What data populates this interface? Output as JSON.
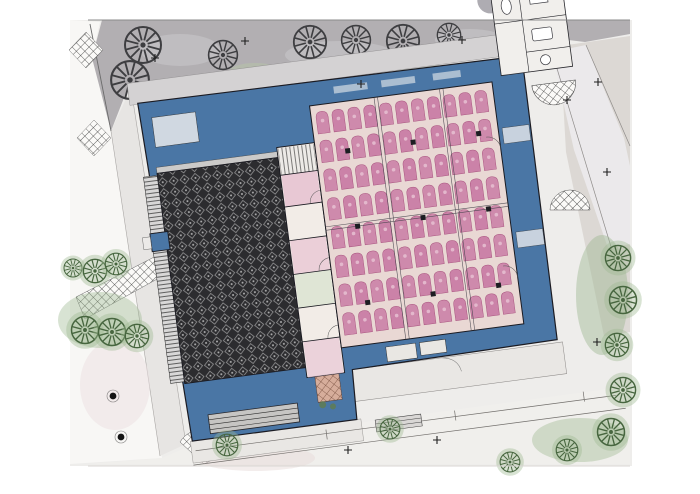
{
  "palette": {
    "page_bg": "#ffffff",
    "plan_bg": "#eeedeb",
    "plaza_white": "#f8f7f5",
    "upper_pavement": "#b2afb2",
    "pavement_blob": "#c3c1c4",
    "green_tint": "#b7c1aa",
    "plaza_path": "#e7e5e3",
    "path_light": "#ebe9eb",
    "stucco": "#dcd8d4",
    "lower_ground": "#f0efec",
    "sidewalk": "#e9e7e4",
    "building_blue": "#4a76a5",
    "wall_line": "#1b1b22",
    "band_room": "#dfe3e8",
    "skylight": "#ccd6e0",
    "courtyard_dark": "#2c2c2f",
    "courtyard_motif": "#c9c9c9",
    "stairs_bg": "#d8d7d7",
    "stairs_line": "#2b2b2b",
    "grille_bg": "#c6c5c3",
    "grille_line": "#2e2e2e",
    "hall_bg": "#e9d8d4",
    "mat_pink": "#c97da5",
    "mat_outline": "#a9547f",
    "mat_dot": "#e6bccf",
    "rooms_bg": "#f2ece7",
    "room_pink": "#e8c8d4",
    "room_green": "#dfe5d5",
    "annex_bg": "#f1efec",
    "fixture_line": "#3a3a40",
    "patch_bg": "#fbfaf8",
    "brick_line": "#3a3a3a",
    "terracotta": "#b05f3e",
    "planting_green": "#5f7d52",
    "tree_dark": "#3e3e41",
    "tree_green": "#47663f",
    "tree_halo": "#9db892",
    "marker_black": "#1f1f1f",
    "dim_line": "#716e6b",
    "border_line": "#8b8b8b",
    "bollard": "#151515"
  },
  "site": {
    "trees_dark": [
      [
        143,
        45,
        20
      ],
      [
        223,
        55,
        16
      ],
      [
        130,
        80,
        21
      ],
      [
        209,
        97,
        14
      ],
      [
        310,
        42,
        18
      ],
      [
        356,
        40,
        16
      ],
      [
        403,
        41,
        18
      ],
      [
        449,
        35,
        13
      ]
    ],
    "trees_green": [
      [
        73,
        268,
        10
      ],
      [
        95,
        271,
        13
      ],
      [
        116,
        264,
        12
      ],
      [
        85,
        330,
        15
      ],
      [
        112,
        332,
        15
      ],
      [
        137,
        336,
        13
      ],
      [
        618,
        258,
        14
      ],
      [
        623,
        300,
        15
      ],
      [
        617,
        345,
        13
      ],
      [
        623,
        390,
        14
      ],
      [
        611,
        432,
        15
      ],
      [
        567,
        450,
        12
      ],
      [
        510,
        462,
        11
      ],
      [
        227,
        445,
        12
      ],
      [
        390,
        429,
        11
      ]
    ],
    "survey_markers": [
      [
        245,
        41
      ],
      [
        155,
        58
      ],
      [
        361,
        84
      ],
      [
        462,
        40
      ],
      [
        598,
        82
      ],
      [
        567,
        100
      ],
      [
        607,
        172
      ],
      [
        597,
        342
      ],
      [
        348,
        450
      ],
      [
        437,
        440
      ]
    ],
    "bollards": [
      [
        113,
        396
      ],
      [
        121,
        437
      ]
    ]
  },
  "building": {
    "rotation_deg": -7.5,
    "mats": {
      "x0": 331,
      "y0": 110,
      "cols": 11,
      "rows": 8,
      "px": 16,
      "py": 29,
      "w": 12,
      "h": 22
    }
  }
}
